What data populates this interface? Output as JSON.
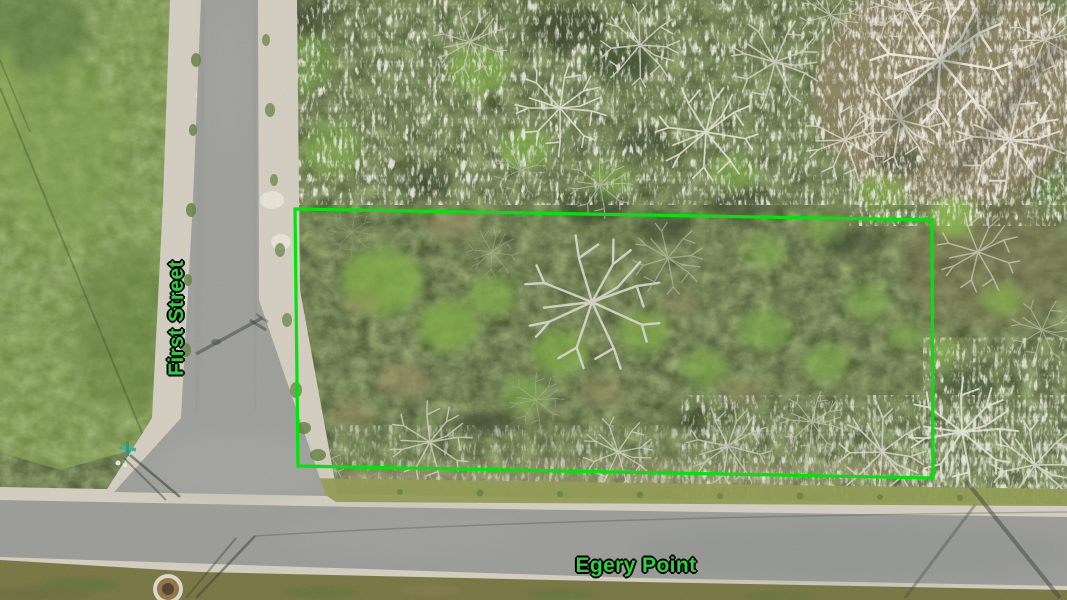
{
  "scene": {
    "type": "aerial-drone-photograph",
    "description": "Overhead drone photo of a vacant brush-covered corner lot outlined in green, at the T-intersection of First Street and Egery Point"
  },
  "annotations": {
    "boundary_color": "#00e40a",
    "label_color": "#2ed142",
    "label_outline_color": "#000000",
    "street_labels": [
      {
        "name": "First Street",
        "orientation": "vertical"
      },
      {
        "name": "Egery Point",
        "orientation": "horizontal"
      }
    ]
  }
}
